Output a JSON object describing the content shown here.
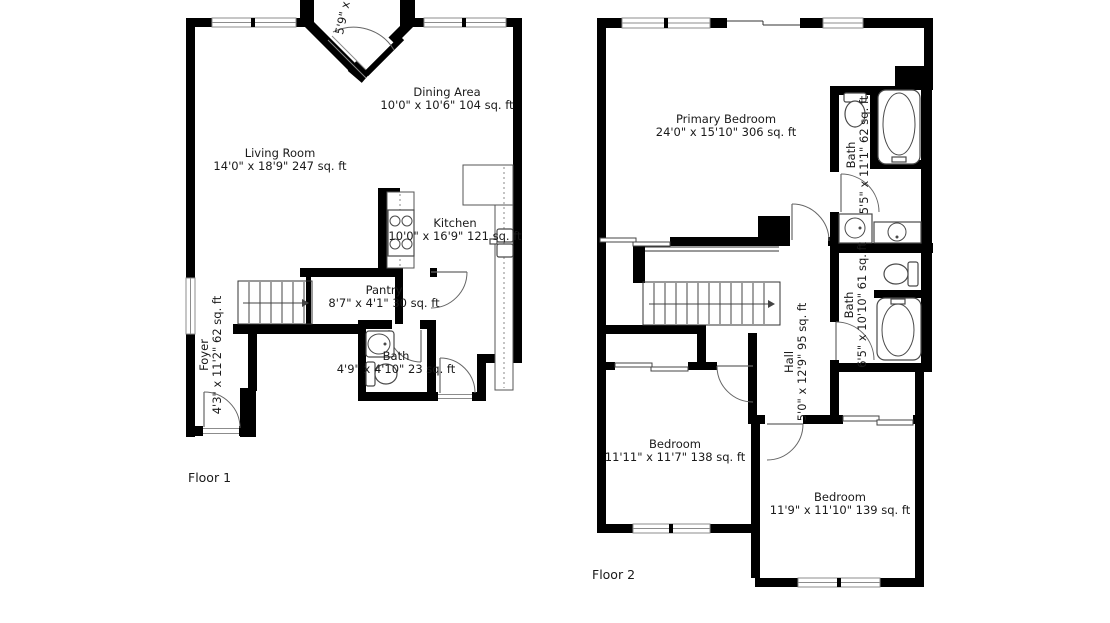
{
  "colors": {
    "wall": "#000000",
    "background": "#ffffff",
    "window_line": "#8c8c8c",
    "fixture_line": "#4a4a4a",
    "text": "#1a1a1a"
  },
  "floor1": {
    "label": "Floor 1",
    "living_room": {
      "name": "Living Room",
      "dims": "14'0\" x 18'9\" 247 sq. ft"
    },
    "dining_area": {
      "name": "Dining Area",
      "dims": "10'0\" x 10'6\" 104 sq. ft"
    },
    "kitchen": {
      "name": "Kitchen",
      "dims": "10'0\" x 16'9\" 121 sq. ft"
    },
    "pantry": {
      "name": "Pantry",
      "dims": "8'7\" x 4'1\" 30 sq. ft"
    },
    "bath": {
      "name": "Bath",
      "dims": "4'9\" x 4'10\" 23 sq. ft"
    },
    "foyer": {
      "name": "Foyer",
      "dims": "4'3\" x 11'2\" 62 sq. ft"
    },
    "entry_partial_dims": "5'9\" x"
  },
  "floor2": {
    "label": "Floor 2",
    "primary_bedroom": {
      "name": "Primary Bedroom",
      "dims": "24'0\" x 15'10\" 306 sq. ft"
    },
    "bath_ensuite": {
      "name": "Bath",
      "dims": "5'5\" x 11'1\" 62 sq. ft"
    },
    "bath_hall": {
      "name": "Bath",
      "dims": "6'5\" x 10'10\" 61 sq. ft"
    },
    "hall": {
      "name": "Hall",
      "dims": "5'0\" x 12'9\" 95 sq. ft"
    },
    "bedroom_left": {
      "name": "Bedroom",
      "dims": "11'11\" x 11'7\" 138 sq. ft"
    },
    "bedroom_right": {
      "name": "Bedroom",
      "dims": "11'9\" x 11'10\" 139 sq. ft"
    }
  }
}
